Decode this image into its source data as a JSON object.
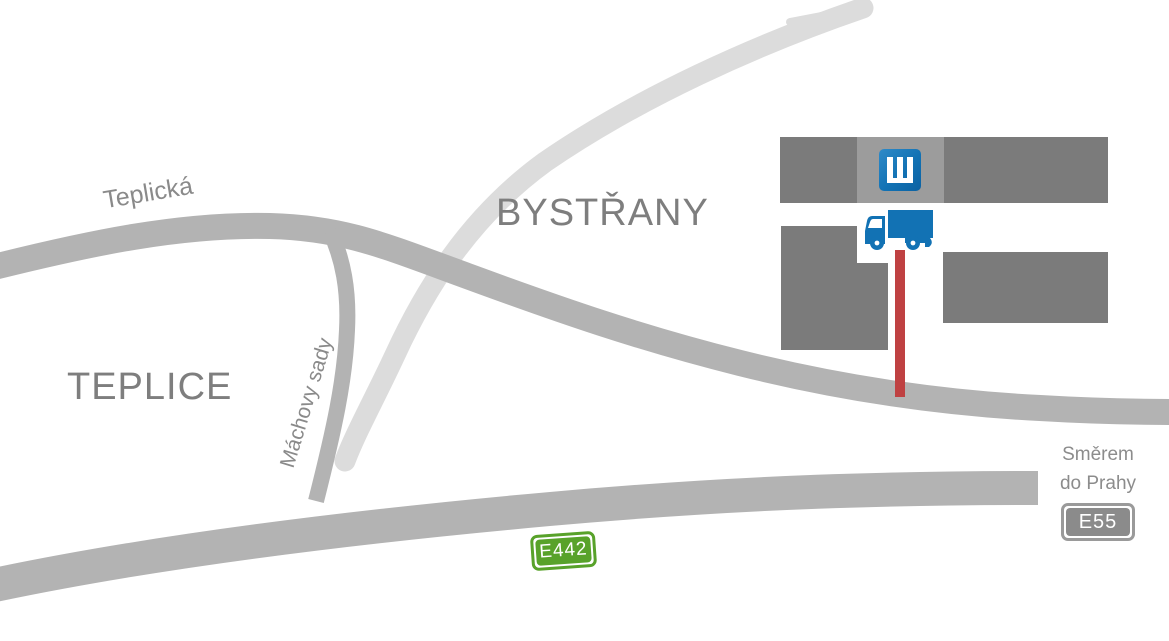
{
  "map": {
    "cities": [
      {
        "name": "TEPLICE"
      },
      {
        "name": "BYSTŘANY"
      }
    ],
    "streets": [
      {
        "name": "Teplická"
      },
      {
        "name": "Máchovy sady"
      }
    ],
    "direction": {
      "line1": "Směrem",
      "line2": "do Prahy"
    },
    "road_badges": [
      {
        "label": "E442",
        "color": "#58a22a"
      },
      {
        "label": "E55",
        "color": "#8b8b8b"
      }
    ],
    "markers": {
      "company_logo": "company-logo-icon",
      "truck": "truck-icon",
      "route_line": "route-highlight-line"
    },
    "colors": {
      "road": "#b3b3b3",
      "road_light": "#dcdcdc",
      "building_dark": "#7b7b7b",
      "building_light": "#9c9c9c",
      "route_red": "#bf4142",
      "brand_blue": "#1272b4",
      "badge_green": "#58a22a",
      "badge_gray": "#8b8b8b",
      "text_gray": "#8c8c8c"
    }
  }
}
